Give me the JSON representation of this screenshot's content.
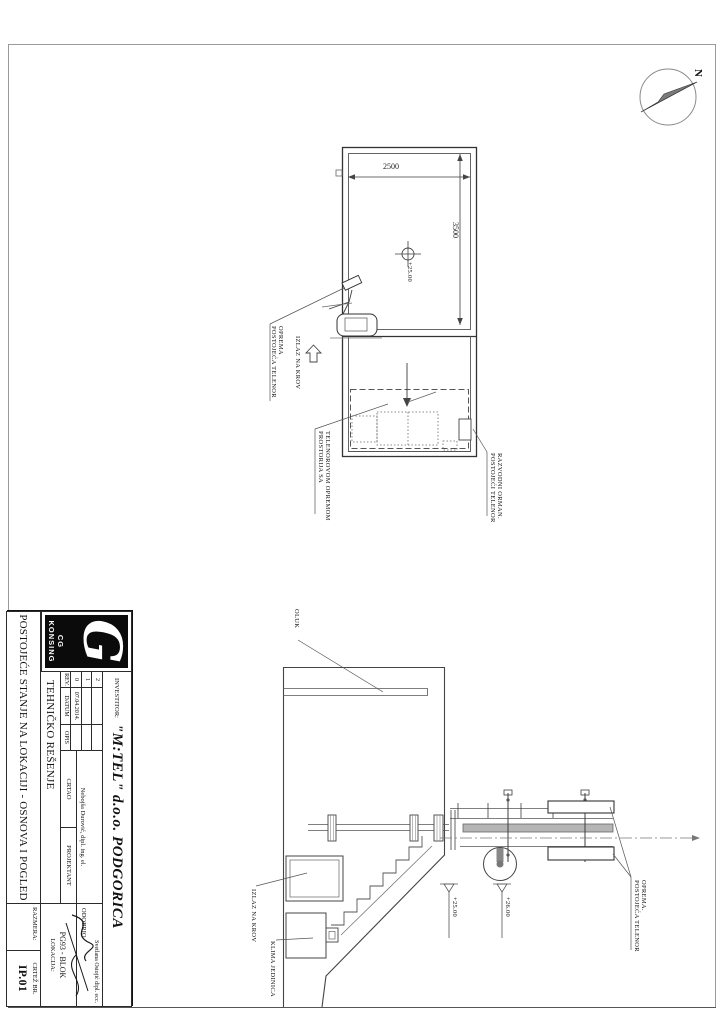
{
  "north": {
    "label": "N"
  },
  "title_block": {
    "logo": {
      "glyph": "G",
      "text": "CG KONSING"
    },
    "investor_label": "INVESTITOR:",
    "investor_name": "\"M:TEL\" d.o.o. PODGORICA",
    "rev_header": {
      "rev": "REV.",
      "datum": "DATUM",
      "opis": "OPIS"
    },
    "rev_rows": [
      {
        "rev": "2",
        "datum": "",
        "opis": ""
      },
      {
        "rev": "1",
        "datum": "",
        "opis": ""
      },
      {
        "rev": "0",
        "datum": "07.04.2014.",
        "opis": ""
      }
    ],
    "drawn_label": "CRTAO",
    "designed_label": "PROJEKTANT",
    "approved_label": "ODOBRIO",
    "drawn_name": "Nebojša Durović, dipl. ing. el.",
    "approved_name": "Svetlana Ostojić dipl. ecc.",
    "solution_title": "TEHNIČKO REŠENJE",
    "location_label": "LOKACIJA:",
    "location_value": "PG93 - BLOK",
    "drawing_title": "POSTOJEĆE STANJE NA LOKACIJI - OSNOVA I POGLED",
    "scale_label": "RAZMERA:",
    "sheet_label": "CRTEŽ BR.",
    "sheet_number": "IP.01"
  },
  "plan": {
    "dim_width": "2500",
    "dim_height": "3500",
    "roof_level": "+25.00",
    "label_equipment_1": "POSTOJEĆA TELENOR",
    "label_equipment_2": "OPREMA",
    "label_exit": "IZLAZ NA KROV",
    "label_room_1": "PROSTORIJA SA",
    "label_room_2": "TELENOROVOM OPREMOM",
    "label_cabinet_1": "POSTOJEĆI TELENOR",
    "label_cabinet_2": "RAZVODNI ORMAN."
  },
  "elevation": {
    "label_gutter": "OLUK",
    "label_exit": "IZLAZ NA KROV",
    "label_ac": "KLIMA JEDINICA",
    "label_equipment_1": "POSTOJEĆA TELENOR",
    "label_equipment_2": "OPREMA.",
    "level_roof": "+25.00",
    "level_top": "+26.00"
  }
}
